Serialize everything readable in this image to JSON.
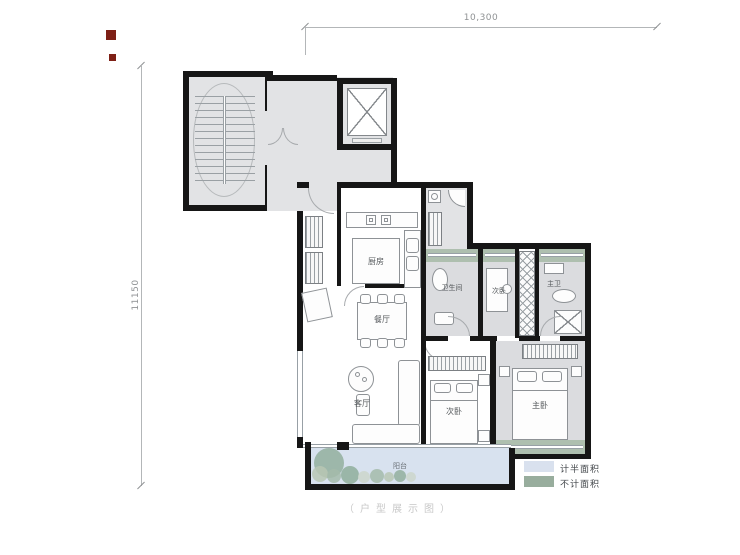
{
  "dimensions": {
    "width_label": "10,300",
    "height_label": "11150"
  },
  "rooms": {
    "kitchen": {
      "label": "厨房"
    },
    "dining": {
      "label": "餐厅"
    },
    "living": {
      "label": "客厅"
    },
    "bathroom": {
      "label": "卫生间"
    },
    "bedroom2_upper": {
      "label": "次卧"
    },
    "master_bath": {
      "label": "主卫"
    },
    "bedroom2_lower": {
      "label": "次卧"
    },
    "master_bedroom": {
      "label": "主卧"
    },
    "balcony": {
      "label": "阳台"
    }
  },
  "legend": {
    "half_area": {
      "label": "计半面积",
      "color": "#d9e1ee"
    },
    "excluded_area": {
      "label": "不计面积",
      "color": "#98ad9d"
    }
  },
  "watermark": "（户型展示图）",
  "colors": {
    "wall": "#161616",
    "public_area": "#e2e3e5",
    "room_gray": "#dbdcdf",
    "bay_window_green": "#aebfaf",
    "balcony_blue": "#d8e2ef",
    "dimension_line": "#b3b6b8",
    "label_text": "#55595c",
    "watermark_gray": "#c8c8c8",
    "logo_red": "#7e2016",
    "plant_greens": [
      "#93af9e",
      "#b9c7b4",
      "#cdd6cb",
      "#a5bbaa"
    ]
  }
}
